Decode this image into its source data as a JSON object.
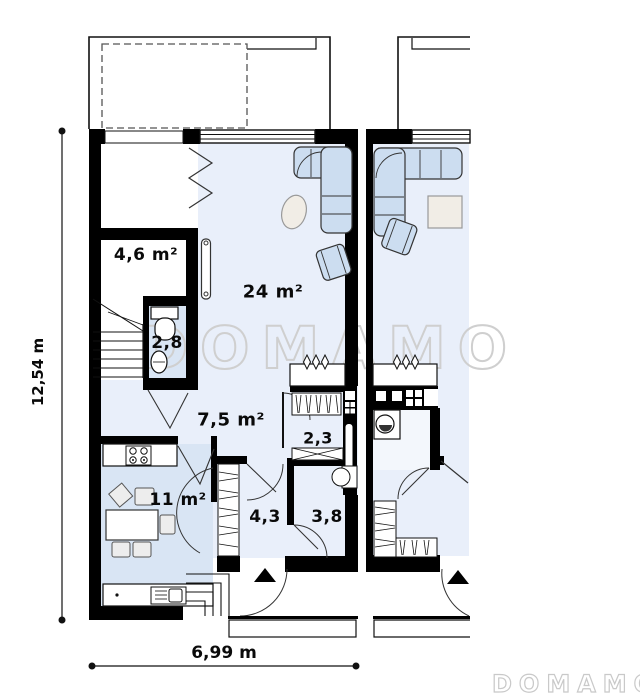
{
  "plan": {
    "watermark_text": "DOMAMO",
    "logo_text": "DOMAMO",
    "dimensions": {
      "height_label": "12,54 m",
      "width_label": "6,99 m"
    },
    "rooms": [
      {
        "name": "storage",
        "area_label": "4,6 m²"
      },
      {
        "name": "toilet",
        "area_label": "2,8"
      },
      {
        "name": "living-room",
        "area_label": "24 m²"
      },
      {
        "name": "hall",
        "area_label": "7,5 m²"
      },
      {
        "name": "wardrobe",
        "area_label": "2,3"
      },
      {
        "name": "kitchen",
        "area_label": "11 m²"
      },
      {
        "name": "corridor",
        "area_label": "4,3"
      },
      {
        "name": "bathroom",
        "area_label": "3,8"
      }
    ],
    "colors": {
      "floor_light": "#e9effa",
      "floor_medium": "#d9e5f4",
      "furniture_blue": "#ccddf0",
      "furniture_beige": "#f1ede6",
      "wall": "#000000",
      "watermark": "#cfcfcf"
    }
  }
}
